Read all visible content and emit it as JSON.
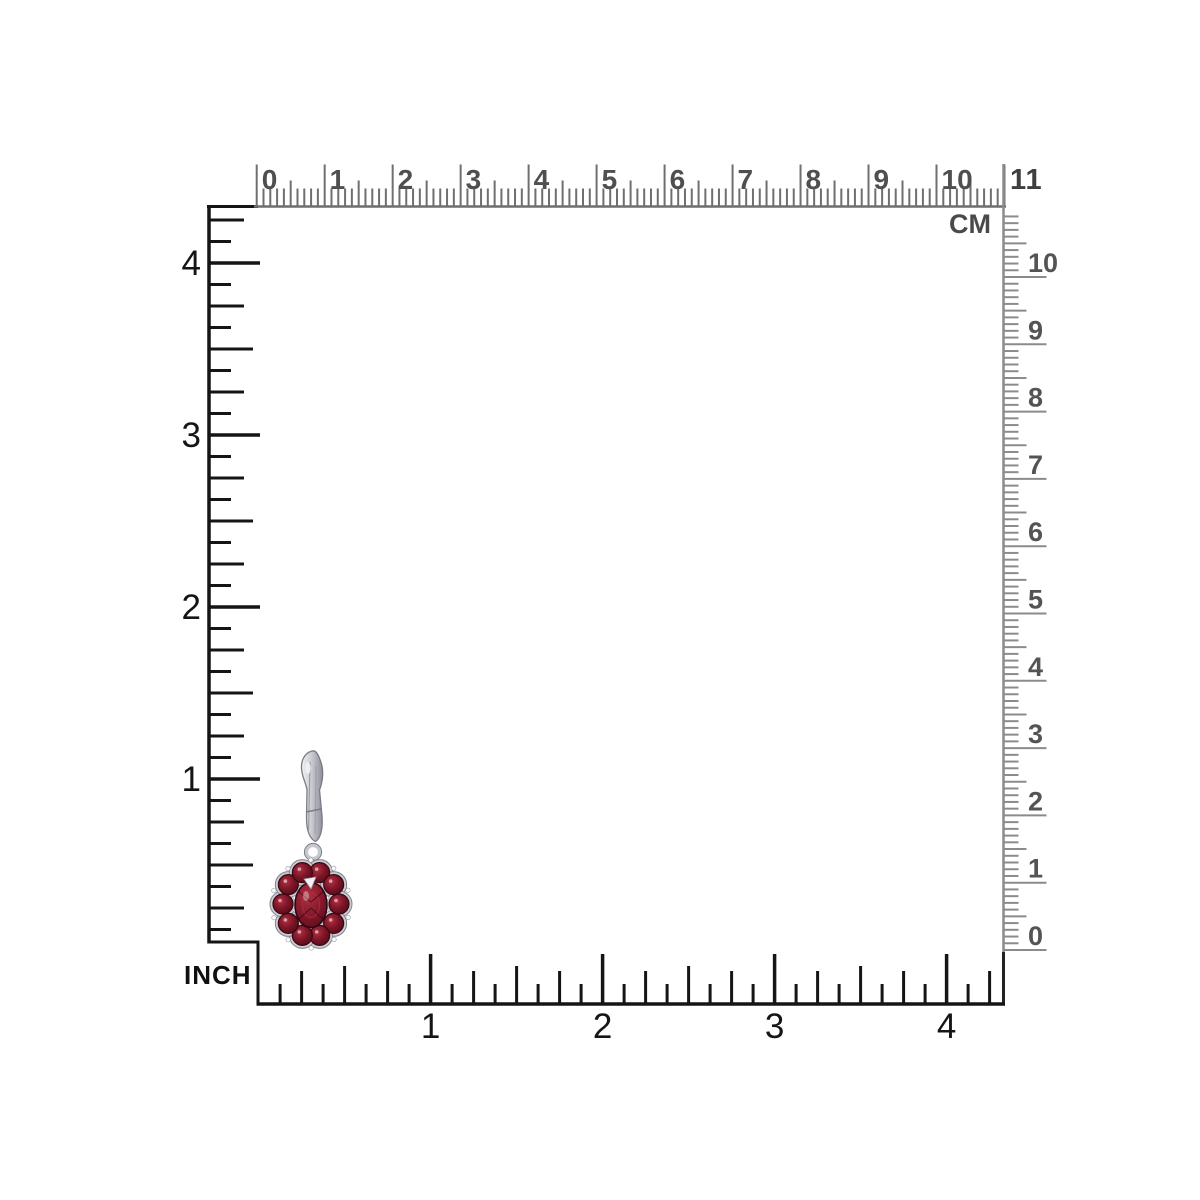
{
  "page": {
    "title": "jewelry-size-chart",
    "background": "#ffffff"
  },
  "rulers": {
    "top_cm": {
      "unit_label": "CM",
      "corner_number": "11",
      "numbers": [
        "0",
        "1",
        "2",
        "3",
        "4",
        "5",
        "6",
        "7",
        "8",
        "9",
        "10"
      ],
      "tick_color": "#6f6f6f",
      "number_color": "#4f4f4f"
    },
    "right_cm": {
      "numbers": [
        "10",
        "9",
        "8",
        "7",
        "6",
        "5",
        "4",
        "3",
        "2",
        "1",
        "0"
      ],
      "tick_color": "#8b8b8b",
      "number_color": "#545454"
    },
    "left_inch": {
      "numbers": [
        "4",
        "3",
        "2",
        "1"
      ],
      "color": "#151515"
    },
    "bottom_inch": {
      "unit_label": "INCH",
      "numbers": [
        "1",
        "2",
        "3",
        "4"
      ],
      "color": "#151515"
    }
  },
  "product": {
    "description": "Sterling silver leverback drop earring with dark red garnet flower cluster and oval center stone",
    "metal_light": "#f3f3f6",
    "metal_mid": "#c7c7ce",
    "metal_dark": "#8e8e98",
    "metal_outline": "#7b7b85",
    "backing_fill": "#cbcbd2",
    "backing_outline": "#83838d",
    "gem_bright": "#b03042",
    "gem_mid": "#7c1527",
    "gem_dark": "#460813",
    "gem_outline": "#380711",
    "sparkle": "#f4f4f6"
  }
}
